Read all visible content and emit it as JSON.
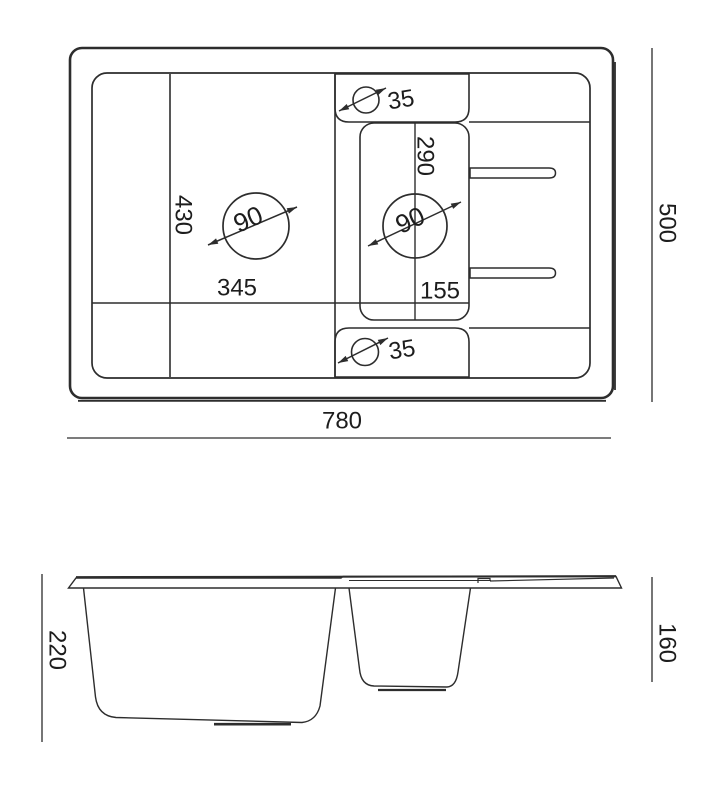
{
  "colors": {
    "background": "#ffffff",
    "line": "#2d2d2d",
    "text": "#1d1d1d"
  },
  "top_view": {
    "overall_width": "780",
    "overall_depth": "500",
    "main_bowl_width": "345",
    "main_bowl_depth": "430",
    "small_bowl_depth": "290",
    "small_bowl_width": "155",
    "main_drain_diameter": "90",
    "small_drain_diameter": "90",
    "top_tap_hole_diameter": "35",
    "bottom_tap_hole_diameter": "35"
  },
  "side_view": {
    "main_bowl_height": "220",
    "small_bowl_height": "160"
  }
}
